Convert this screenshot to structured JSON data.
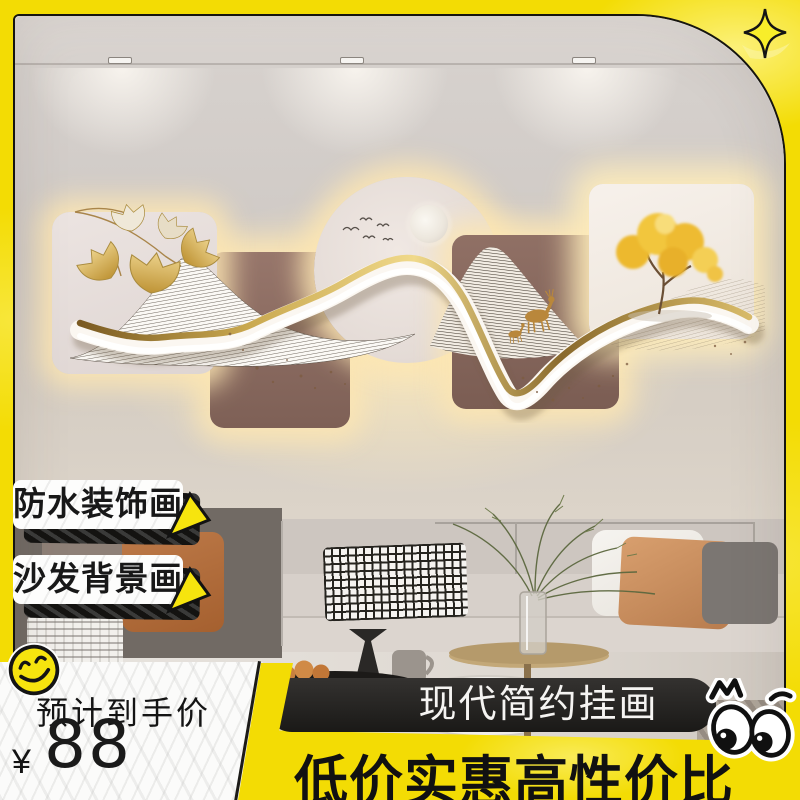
{
  "badges": {
    "items": [
      {
        "label": "防水装饰画"
      },
      {
        "label": "沙发背景画"
      }
    ]
  },
  "price_panel": {
    "label": "预计到手价",
    "currency": "¥",
    "amount": "88"
  },
  "banner": {
    "title": "现代简约挂画"
  },
  "tagline": {
    "text": "低价实惠高性价比"
  },
  "icons": {
    "sparkle": "four-point-star",
    "smiley": "winking-smiley-face",
    "eyes": "peeking-cartoon-eyes",
    "badge_arrow": "yellow-cursor-arrow"
  },
  "colors": {
    "frame_yellow": "#f3dc04",
    "banner_black": "#1a1917",
    "paper_white": "#fbfbfa",
    "text_black": "#141414",
    "gold_accent": "#c9a84f"
  }
}
